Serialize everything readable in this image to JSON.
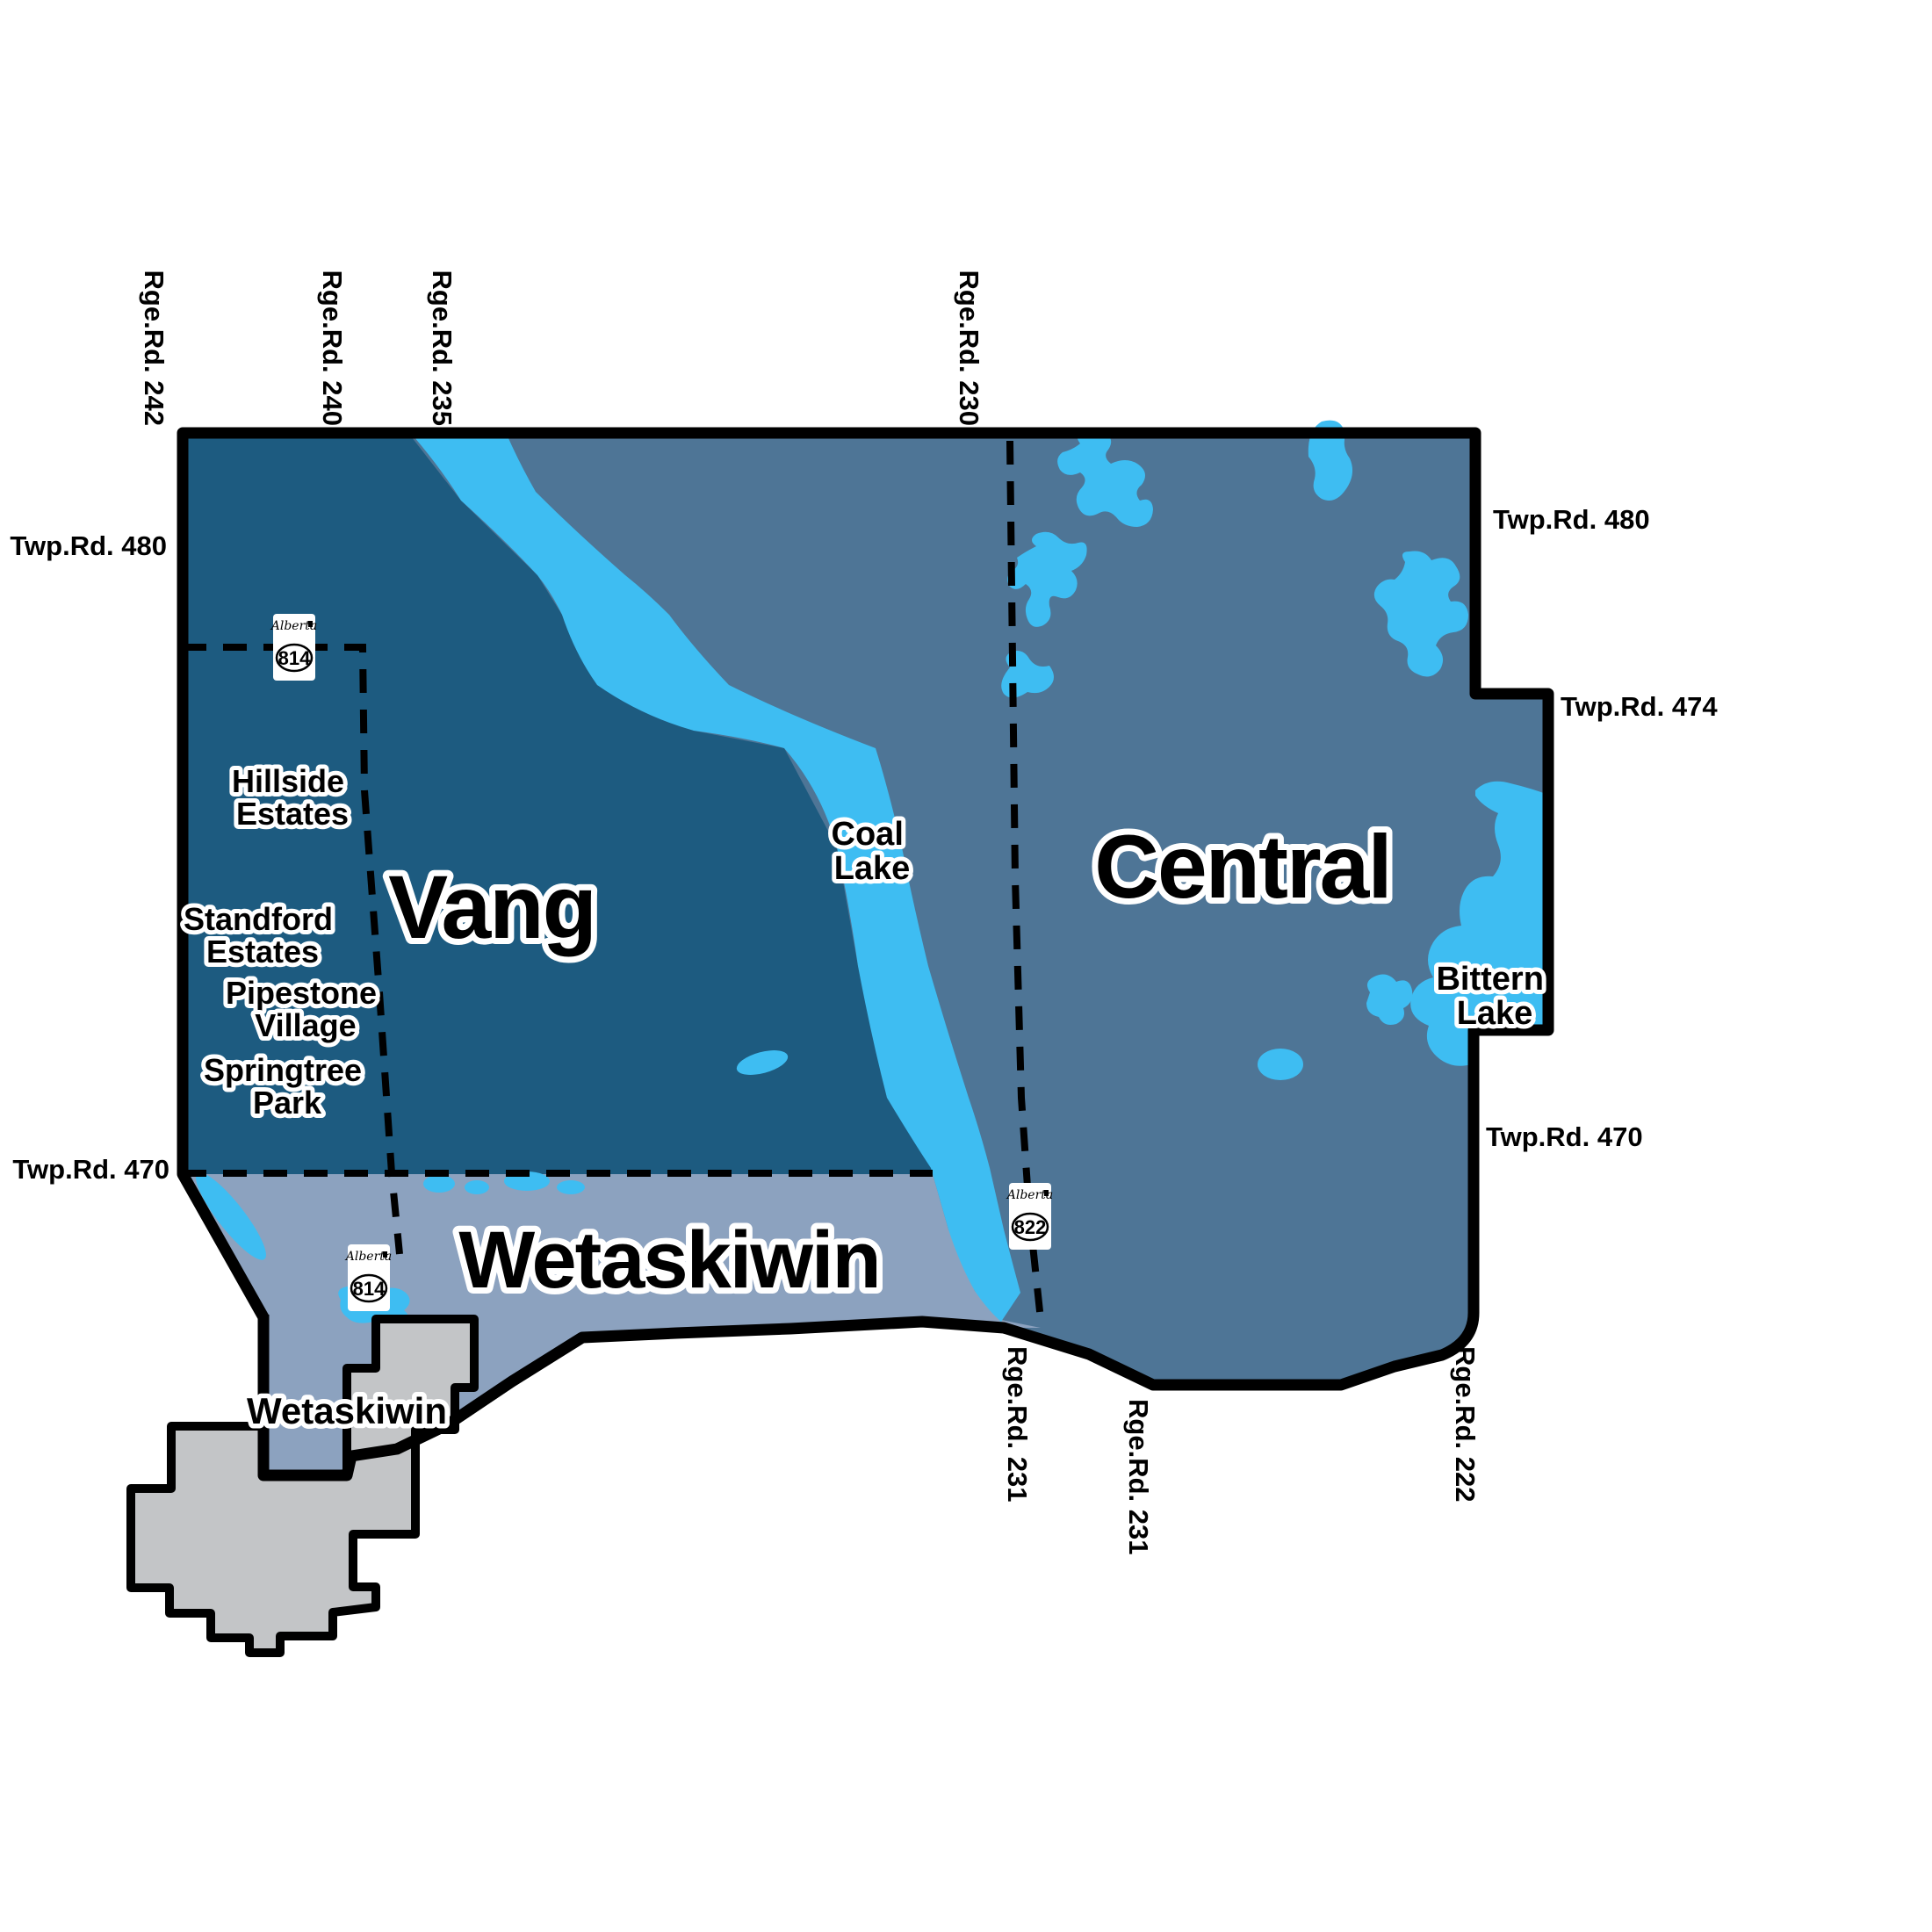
{
  "colors": {
    "vang": "#1d5b80",
    "central": "#4e7596",
    "wetaskiwin_division": "#8ca2bf",
    "water": "#3ebdf2",
    "city": "#c3c5c7",
    "outside": "#ffffff",
    "border": "#000000"
  },
  "regions": [
    {
      "name": "Vang",
      "label": "Vang"
    },
    {
      "name": "Central",
      "label": "Central"
    },
    {
      "name": "Wetaskiwin (rural division)",
      "label": "Wetaskiwin"
    }
  ],
  "city": {
    "label": "Wetaskiwin"
  },
  "lakes": [
    {
      "name": "Coal Lake",
      "line1": "Coal",
      "line2": "Lake"
    },
    {
      "name": "Bittern Lake",
      "line1": "Bittern",
      "line2": "Lake"
    }
  ],
  "settlements": [
    {
      "line1": "Hillside",
      "line2": "Estates"
    },
    {
      "line1": "Standford",
      "line2": "Estates"
    },
    {
      "line1": "Pipestone",
      "line2": "Village"
    },
    {
      "line1": "Springtree",
      "line2": "Park"
    }
  ],
  "roads": {
    "range_roads_top": [
      "Rge.Rd. 242",
      "Rge.Rd. 240",
      "Rge.Rd. 235",
      "Rge.Rd. 230"
    ],
    "range_roads_bottom": [
      "Rge.Rd. 231",
      "Rge.Rd. 231",
      "Rge.Rd. 222"
    ],
    "township_roads_left": [
      "Twp.Rd. 480",
      "Twp.Rd. 470"
    ],
    "township_roads_right": [
      "Twp.Rd. 480",
      "Twp.Rd. 474",
      "Twp.Rd. 470"
    ]
  },
  "highway_shields": [
    {
      "province": "Alberta",
      "number": "814"
    },
    {
      "province": "Alberta",
      "number": "814"
    },
    {
      "province": "Alberta",
      "number": "822"
    }
  ]
}
